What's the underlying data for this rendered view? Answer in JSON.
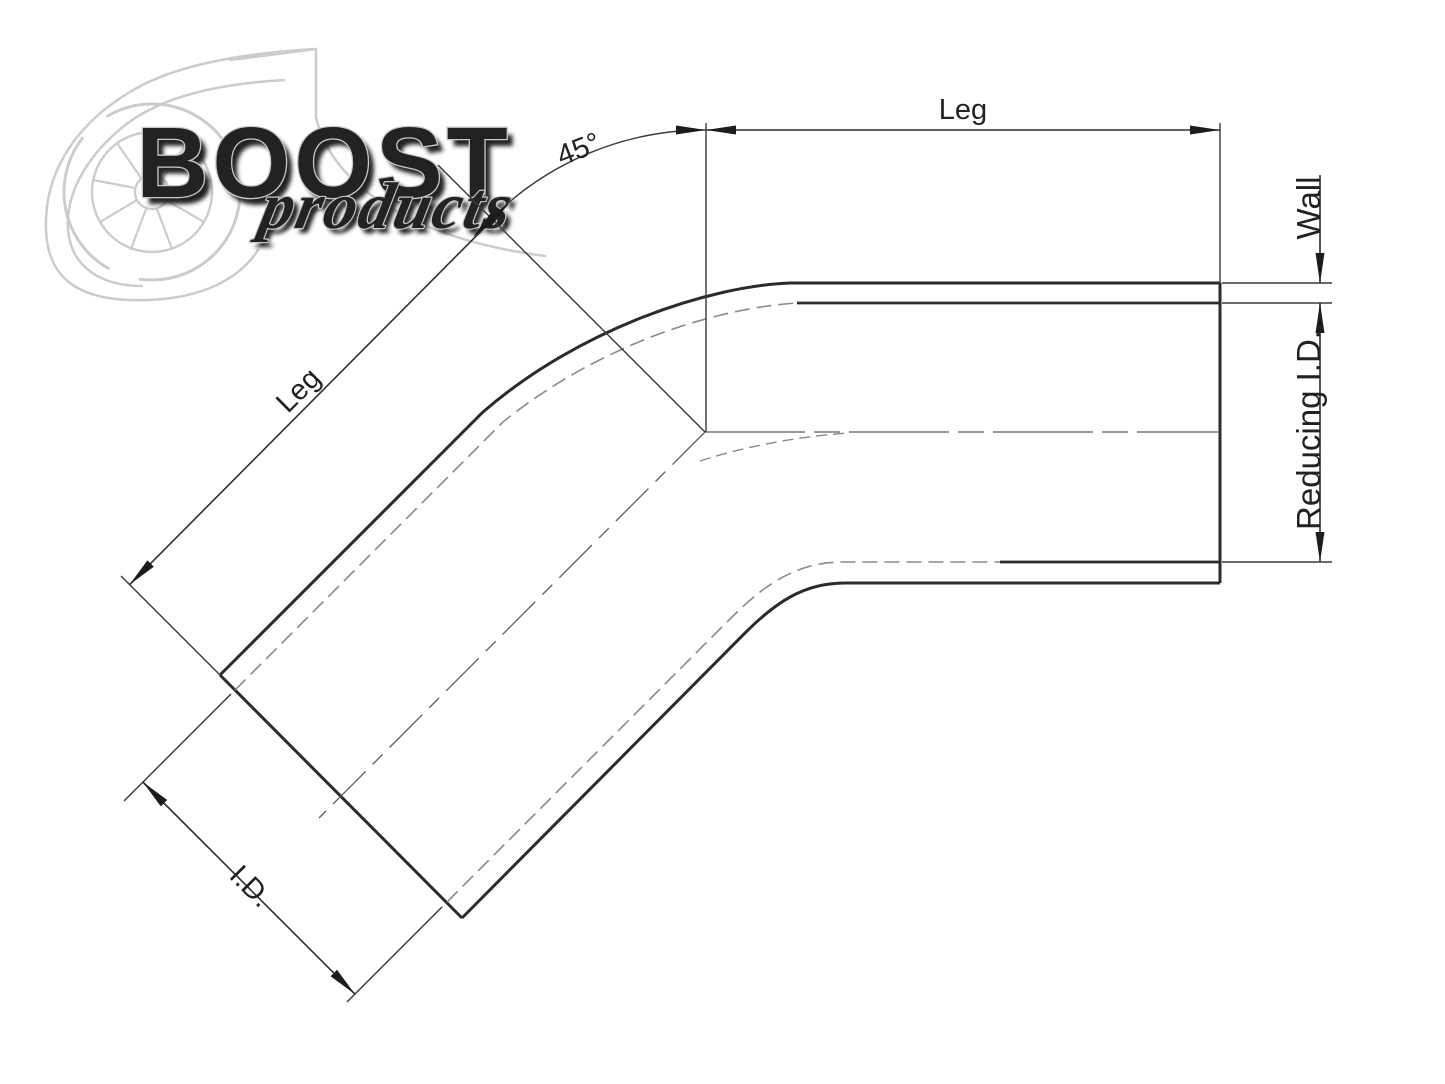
{
  "page": {
    "background": "#ffffff"
  },
  "watermark": {
    "brand": "BOOST",
    "brand_sub": "products",
    "color": "#cccccc",
    "shadow_color": "#dddddd"
  },
  "diagram": {
    "part": "45-degree reducing elbow",
    "labels": {
      "leg_right": "Leg",
      "leg_left": "Leg",
      "angle": "45°",
      "wall": "Wall",
      "reducing_id": "Reducing I.D.",
      "id": "I.D."
    },
    "colors": {
      "edge": "#2b2b2b",
      "dim": "#2f2f2f",
      "thin": "#3a3a3a",
      "hidden": "#8a8a8a",
      "center": "#5a5a5a",
      "arrow": "#1c1c1c",
      "text": "#222222"
    }
  }
}
